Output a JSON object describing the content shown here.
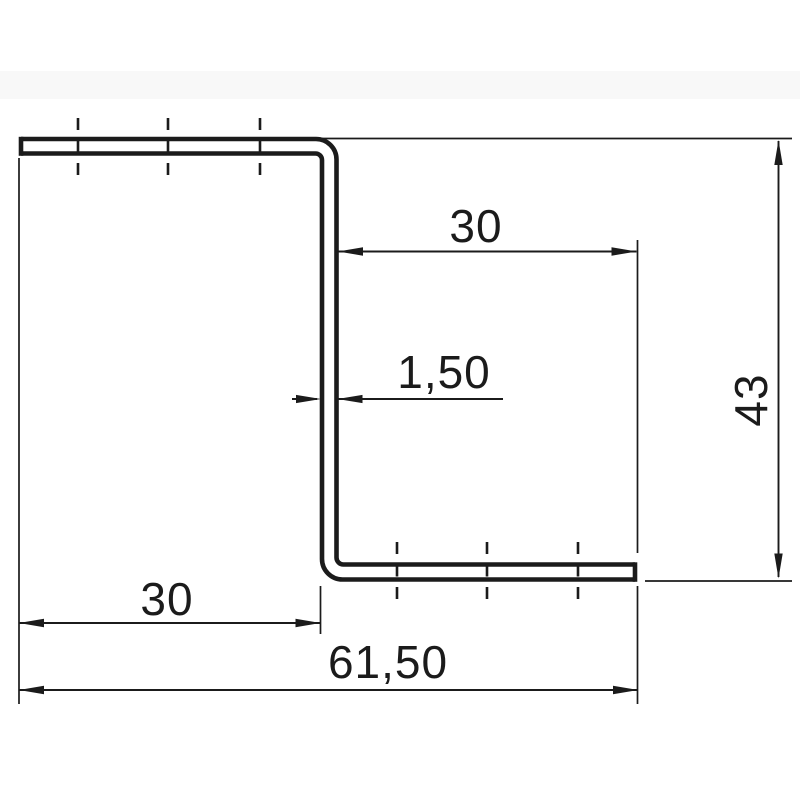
{
  "drawing": {
    "description": "Z-profile sheet metal cross-section technical drawing",
    "line_color": "#1b1b1b",
    "background_color": "#ffffff",
    "dimensions": [
      {
        "id": "right-flange-length",
        "label": "30",
        "orientation": "horizontal",
        "location": "top-right"
      },
      {
        "id": "material-thickness",
        "label": "1,50",
        "orientation": "horizontal",
        "location": "center-at-web"
      },
      {
        "id": "profile-height",
        "label": "43",
        "orientation": "vertical",
        "location": "right-edge"
      },
      {
        "id": "left-flange-length",
        "label": "30",
        "orientation": "horizontal",
        "location": "bottom-left"
      },
      {
        "id": "overall-width",
        "label": "61,50",
        "orientation": "horizontal",
        "location": "bottom"
      }
    ]
  }
}
